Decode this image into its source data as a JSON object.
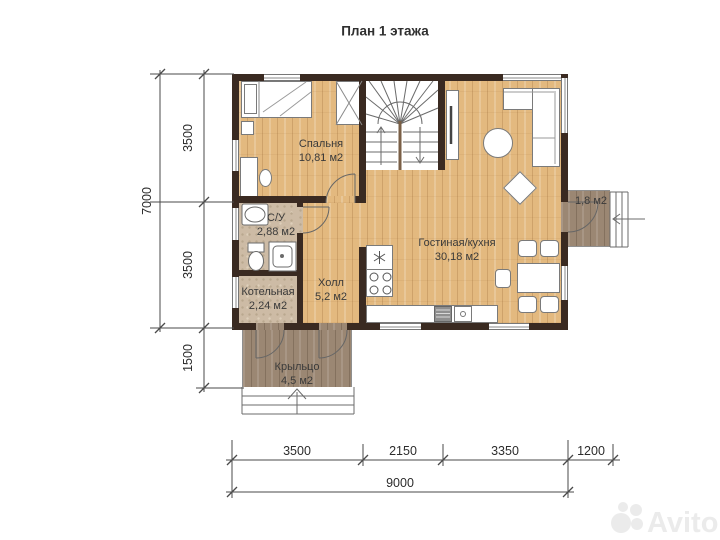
{
  "title": "План 1 этажа",
  "rooms": {
    "bedroom": {
      "name": "Спальня",
      "area": "10,81 м2"
    },
    "bathroom": {
      "name": "С/У",
      "area": "2,88 м2"
    },
    "boiler": {
      "name": "Котельная",
      "area": "2,24 м2"
    },
    "hall": {
      "name": "Холл",
      "area": "5,2 м2"
    },
    "living": {
      "name": "Гостиная/кухня",
      "area": "30,18 м2"
    },
    "porch": {
      "name": "Крыльцо",
      "area": "4,5 м2"
    },
    "entry": {
      "area": "1,8 м2"
    }
  },
  "dimensions": {
    "left": {
      "total": "7000",
      "segments": [
        "3500",
        "3500",
        "1500"
      ]
    },
    "bottom": {
      "segments": [
        "3500",
        "2150",
        "3350",
        "1200"
      ],
      "total": "9000"
    }
  },
  "watermark": {
    "brand": "Avito"
  },
  "colors": {
    "wall": "#3a2a21",
    "wood_floor": "#e3b97f",
    "tile_floor": "#cdbba5",
    "porch_floor": "#9b8773",
    "line": "#555555",
    "text": "#333333",
    "watermark": "#ebebeb"
  }
}
